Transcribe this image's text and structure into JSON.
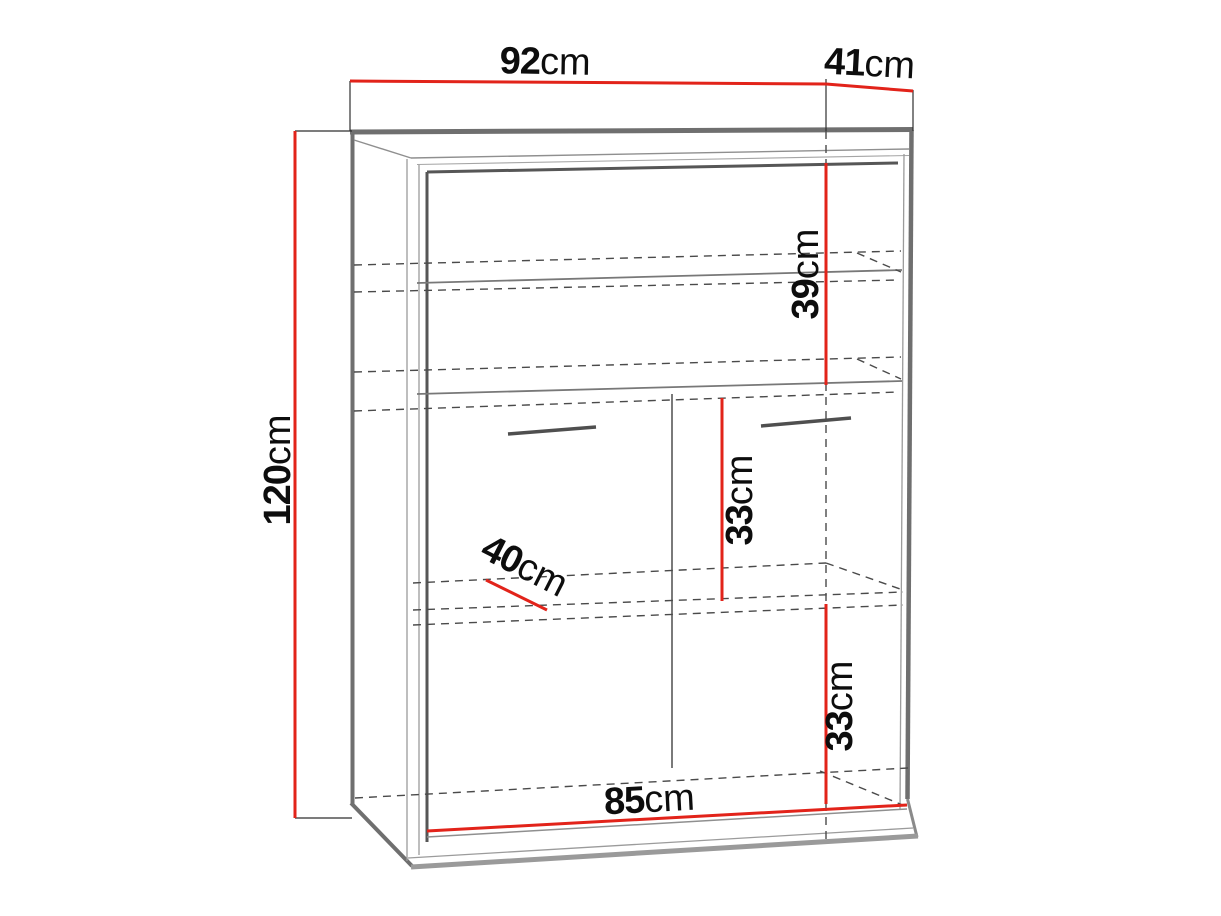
{
  "diagram": {
    "kind": "cabinet-dimension-drawing",
    "unit": "cm",
    "dimensions": {
      "width": {
        "value": "92",
        "unit": "cm"
      },
      "depth": {
        "value": "41",
        "unit": "cm"
      },
      "height": {
        "value": "120",
        "unit": "cm"
      },
      "top_section": {
        "value": "39",
        "unit": "cm"
      },
      "middle_section": {
        "value": "33",
        "unit": "cm"
      },
      "shelf_depth": {
        "value": "40",
        "unit": "cm"
      },
      "bottom_section": {
        "value": "33",
        "unit": "cm"
      },
      "inner_width": {
        "value": "85",
        "unit": "cm"
      }
    },
    "colors": {
      "dimension_line": "#e2231a",
      "outline": "#6f6f6f",
      "hidden_edge": "#4a4a4a",
      "text": "#0d0d0d",
      "background": "#ffffff"
    }
  }
}
